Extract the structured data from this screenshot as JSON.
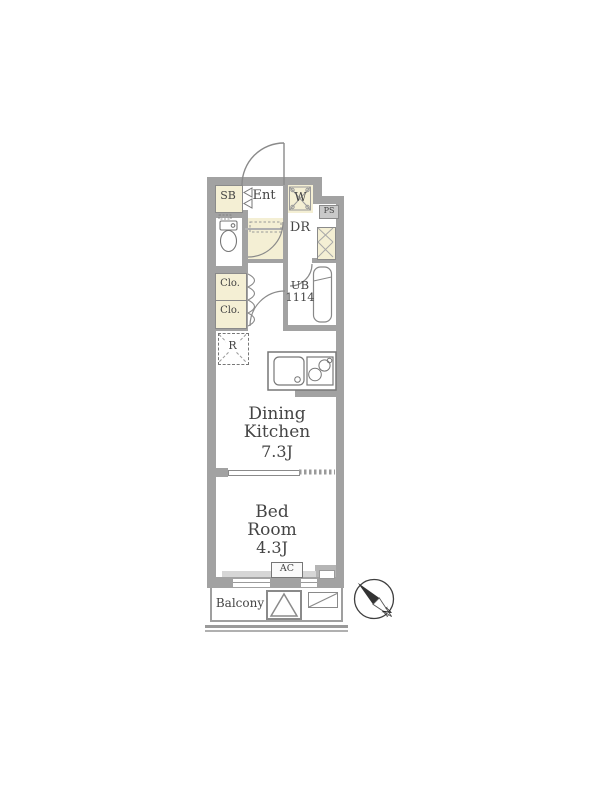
{
  "floorplan": {
    "rooms": {
      "shoe_box": "SB",
      "entrance": "Ent",
      "washer_space": "W",
      "pipe_space": "PS",
      "dressing_room": "DR",
      "unit_bath_line1": "UB",
      "unit_bath_line2": "1114",
      "closet1": "Clo.",
      "closet2": "Clo.",
      "refrigerator_space": "R",
      "dining_kitchen_name": "Dining Kitchen",
      "dining_kitchen_size": "7.3J",
      "bedroom_name": "Bed Room",
      "bedroom_size": "4.3J",
      "air_conditioner": "AC",
      "balcony": "Balcony"
    },
    "compass": {
      "north_label": "N"
    },
    "colors": {
      "wall_gray": "#a2a2a2",
      "fixture_light_gray": "#c9c9c9",
      "room_cream": "#f4efd4",
      "line_gray": "#8a8a8a",
      "text_gray": "#454545"
    }
  }
}
